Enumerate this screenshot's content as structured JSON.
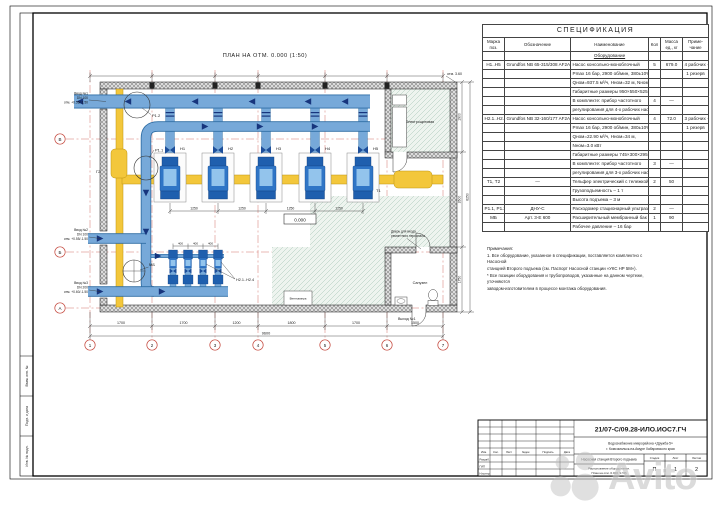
{
  "plan": {
    "title": "ПЛАН НА ОТМ. 0.000 (1:50)",
    "labels": {
      "pumps_main": [
        "Н1",
        "Н2",
        "Н3",
        "Н4",
        "Н5"
      ],
      "pumps_small_group": "Н2.1..Н2.4",
      "flow1": "Р1.1",
      "flow2": "Р1.2",
      "tank": "МБ",
      "g2": "Г2",
      "hoist": "Т1",
      "room_electrical": "Электрощитовая",
      "room_bathroom": "Санузел",
      "room_vent": "Венткамера",
      "door_note_1": "Дверь для входа",
      "door_note_2": "ремонтного персонала",
      "exit": "Выход №1",
      "roof_note": "отм. 3.60",
      "elevation": "0.000"
    },
    "callouts": [
      {
        "l1": "Ввод №1",
        "l2": "DN 100",
        "l3": "отм. +0.55/-1.50"
      },
      {
        "l1": "Ввод №2",
        "l2": "DN 100",
        "l3": "отм. +0.55/-1.50"
      },
      {
        "l1": "Ввод №3",
        "l2": "DN 200",
        "l3": "отм. +0.60/-1.50"
      }
    ],
    "axes_bottom": [
      "1",
      "2",
      "3",
      "4",
      "5",
      "6",
      "7"
    ],
    "axes_left": [
      "В",
      "Б",
      "А"
    ],
    "dims": {
      "bottom": [
        "1700",
        "1700",
        "1200",
        "1800",
        "1700",
        "1500"
      ],
      "bottom_total": "9600",
      "right": [
        "1900",
        "2600",
        "1750"
      ],
      "right_total": "6250",
      "pump_spacing": [
        "1250",
        "1250",
        "1250",
        "1250"
      ],
      "small_spacing": [
        "400",
        "400",
        "400"
      ]
    }
  },
  "spec": {
    "title": "СПЕЦИФИКАЦИЯ",
    "columns": [
      "Марка\nпоз.",
      "Обозначение",
      "Наименование",
      "Кол",
      "Масса\nед., кг",
      "Приме-\nчание"
    ],
    "rows": [
      [
        "",
        "",
        "Оборудование",
        "",
        "",
        ""
      ],
      [
        "Н1..Н5",
        "Grundfos NB 65-315/308 AF2ABQQE",
        "Насос консольно-моноблочный",
        "5",
        "679.0",
        "4 рабочих +"
      ],
      [
        "",
        "",
        "Pmax 16 бар, 2900 об/мин, 380±10% В",
        "",
        "",
        "1 резерв"
      ],
      [
        "",
        "",
        "Qном=937.5 м³/ч, Hном=32 м, Nном=90 кВт",
        "",
        "",
        ""
      ],
      [
        "",
        "",
        "Габаритные размеры 950×550×525 мм",
        "",
        "",
        ""
      ],
      [
        "",
        "",
        "В комплекте: прибор частотного",
        "4",
        "—",
        ""
      ],
      [
        "",
        "",
        "регулирования для 4-х рабочих насосов",
        "",
        "",
        ""
      ],
      [
        "Н2.1..Н2.4",
        "Grundfos NB 32-160/177 AF2ABQQE",
        "Насос консольно-моноблочный",
        "4",
        "72.0",
        "3 рабочих +"
      ],
      [
        "",
        "",
        "Pmax 16 бар, 2900 об/мин, 380±10% В",
        "",
        "",
        "1 резерв"
      ],
      [
        "",
        "",
        "Qном=22.90 м³/ч, Hном=34 м,",
        "",
        "",
        ""
      ],
      [
        "",
        "",
        "Nном=3.0 кВт",
        "",
        "",
        ""
      ],
      [
        "",
        "",
        "Габаритные размеры 745×300×295 мм",
        "",
        "",
        ""
      ],
      [
        "",
        "",
        "В комплекте: прибор частотного",
        "3",
        "—",
        ""
      ],
      [
        "",
        "",
        "регулирования для 3-х рабочих насосов",
        "",
        "",
        ""
      ],
      [
        "Т1, Т2",
        "—",
        "Тельфер электрический с тележкой",
        "2",
        "50",
        ""
      ],
      [
        "",
        "",
        "Грузоподъемность – 1 т",
        "",
        "",
        ""
      ],
      [
        "",
        "",
        "Высота подъема – 3 м",
        "",
        "",
        ""
      ],
      [
        "Р1.1, Р1.2",
        "ДНУ-С",
        "Расходомер стационарный ультразвуковой",
        "2",
        "—",
        ""
      ],
      [
        "МБ",
        "Арт. 3-Е 600",
        "Расширительный мембранный бак",
        "1",
        "90",
        ""
      ],
      [
        "",
        "",
        "Рабочее давление – 16 бар",
        "",
        "",
        ""
      ]
    ]
  },
  "notes": {
    "text": "Примечания:\n1. Все оборудование, указанное в спецификации, поставляется комплектно с Насосной\nстанцией Второго подъема (см. Паспорт Насосной станции «УКС НР 5М»).\n* Все позиции оборудования и трубопроводов, указанные на данном чертеже, уточняются\nзаводом-изготовителем в процессе монтажа оборудования."
  },
  "titleblock": {
    "doc_number": "21/07-С/09.28-ИЛО.ИОС7.ГЧ",
    "project_l1": "Водоснабжение микрорайона «Дружба-5»",
    "project_l2": "г. Комсомольск-на-Амуре Хабаровского края",
    "object": "Насосная станция Второго подъема",
    "drawing_l1": "Расположение оборудования.",
    "drawing_l2": "План на отм. 0.000 (1:50)",
    "stage_label": "Стадия",
    "sheet_label": "Лист",
    "sheets_label": "Листов",
    "stage": "П",
    "sheet": "1",
    "sheets": "2",
    "header_cells": [
      "Изм.",
      "Кол.",
      "Лист",
      "№док.",
      "Подпись",
      "Дата"
    ],
    "roles": [
      "Разраб.",
      "ГИП",
      "Н.контр."
    ]
  },
  "side_stamp": [
    "Взам. инв. №",
    "Подп. и дата",
    "Инв. № подл."
  ],
  "watermark": {
    "text": "Avito"
  },
  "colors": {
    "pipe_blue": "#77a9d9",
    "pipe_blue_dark": "#2e6da4",
    "arrow_navy": "#17357d",
    "pump_blue": "#2f75c6",
    "yellow": "#f3c73b",
    "axis_red": "#c4453a"
  }
}
